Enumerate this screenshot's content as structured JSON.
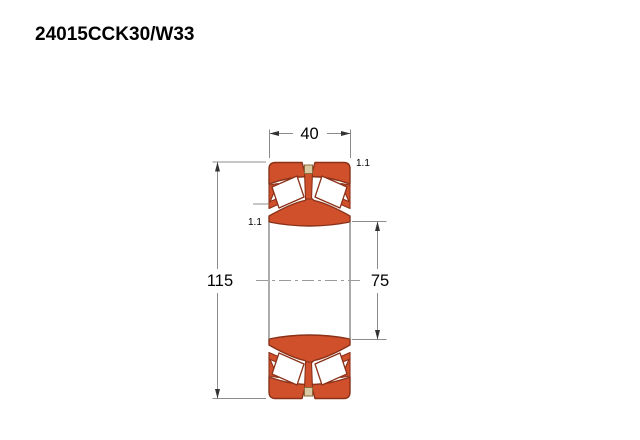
{
  "title": "24015CCK30/W33",
  "drawing": {
    "type": "spherical-roller-bearing-cross-section",
    "labels": {
      "width": "40",
      "outer_diameter": "115",
      "bore_diameter": "75",
      "chamfer_inner": "1.1",
      "chamfer_outer": "1.1"
    },
    "colors": {
      "ring_fill": "#d0502c",
      "ring_stroke": "#8a3118",
      "roller_fill": "#ffffff",
      "cage_block_fill": "#d9c9a4",
      "cage_block_stroke": "#8a6a3a",
      "dim_line": "#8c8c8c",
      "bore_line": "#7f7f7f",
      "centerline": "#9a9a9a",
      "arrow_fill": "#333333",
      "text": "#000000"
    }
  }
}
